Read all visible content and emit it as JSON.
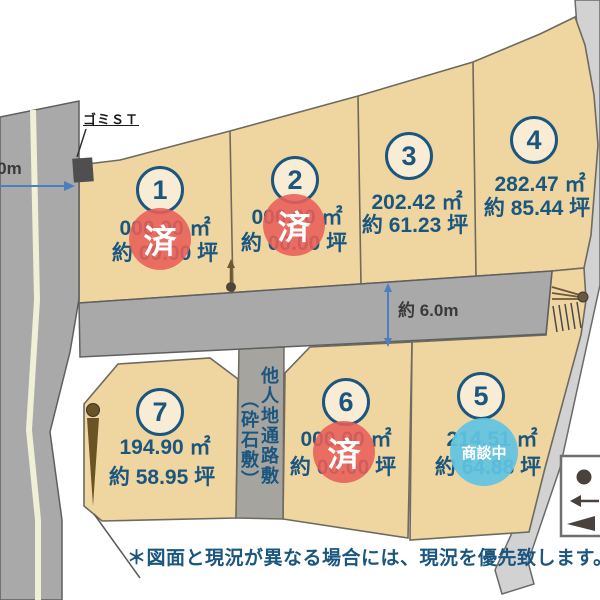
{
  "title": "分譲地 区画図",
  "note": "＊図面と現況が異なる場合には、現況を優先致します。",
  "labels": {
    "garbage_station": "ゴミＳＴ",
    "left_road_width": "6.0m",
    "middle_road_width": "約 6.0m",
    "passage_strip_main": "他人地通路敷",
    "passage_strip_sub": "（砕石敷）"
  },
  "status": {
    "sold": "済",
    "negotiating": "商談中"
  },
  "lots": [
    {
      "number": "1",
      "area_m2": "000.00 ㎡",
      "area_tsubo": "約 00.00 坪",
      "status": "sold"
    },
    {
      "number": "2",
      "area_m2": "000.00 ㎡",
      "area_tsubo": "約 00.00 坪",
      "status": "sold"
    },
    {
      "number": "3",
      "area_m2": "202.42 ㎡",
      "area_tsubo": "約 61.23 坪",
      "status": ""
    },
    {
      "number": "4",
      "area_m2": "282.47 ㎡",
      "area_tsubo": "約 85.44 坪",
      "status": ""
    },
    {
      "number": "5",
      "area_m2": "214.51 ㎡",
      "area_tsubo": "約 64.88 坪",
      "status": "negotiating"
    },
    {
      "number": "6",
      "area_m2": "000.00 ㎡",
      "area_tsubo": "約 00.00 坪",
      "status": "sold"
    },
    {
      "number": "7",
      "area_m2": "194.90 ㎡",
      "area_tsubo": "約 58.95 坪",
      "status": ""
    }
  ],
  "legend": {
    "symbols": [
      "pole-dot",
      "left-arrow",
      "guy-anchor-triangle"
    ]
  },
  "colors": {
    "accent_navy": "#1b567f",
    "sold_red": "#e95f58",
    "negotiation_blue": "#5fc3e2",
    "lot_beige": "#efd5a0",
    "road_gray": "#a9a9a9",
    "diagonal_path_gray": "#d2d2d2",
    "strip_gray": "#a5a49e",
    "dimension_blue": "#4d7ebf"
  }
}
